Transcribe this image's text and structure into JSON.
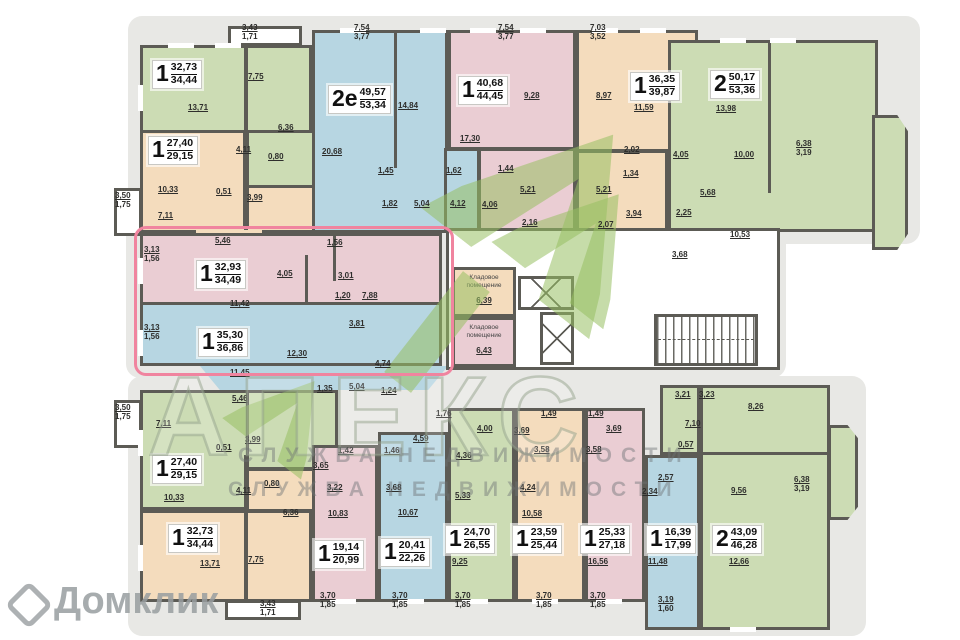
{
  "colors": {
    "wall": "#5c5b55",
    "green_unit": "#ccdcb4",
    "blue_unit": "#b7d6e2",
    "pink_unit": "#eacdd3",
    "orange_unit": "#f4dcbd",
    "highlight": "#f0849f",
    "watermark_green": "#98c062"
  },
  "units": [
    {
      "num": "1",
      "a1": "32,73",
      "a2": "34,44",
      "dims": [
        "13,71",
        "7,75",
        "6,36",
        "4,11",
        "0,80"
      ],
      "bay": [
        "3,43",
        "1,71"
      ]
    },
    {
      "num": "1",
      "a1": "27,40",
      "a2": "29,15",
      "dims": [
        "10,33",
        "0,51",
        "3,99",
        "7,11",
        "5,46"
      ],
      "bay": [
        "3,50",
        "1,75"
      ]
    },
    {
      "num": "2е",
      "a1": "49,57",
      "a2": "53,34",
      "dims": [
        "20,68",
        "14,84",
        "1,45",
        "1,82",
        "5,04",
        "1,62",
        "4,12"
      ],
      "bay": [
        "7,54",
        "3,77"
      ]
    },
    {
      "num": "1",
      "a1": "40,68",
      "a2": "44,45",
      "dims": [
        "17,30",
        "9,28",
        "1,44",
        "5,21",
        "4,06",
        "2,16"
      ],
      "bay": [
        "7,54",
        "3,77"
      ]
    },
    {
      "num": "1",
      "a1": "36,35",
      "a2": "39,87",
      "dims": [
        "11,59",
        "8,97",
        "2,02",
        "1,34",
        "5,21",
        "3,94",
        "2,07"
      ],
      "bay": [
        "7,03",
        "3,52"
      ]
    },
    {
      "num": "2",
      "a1": "50,17",
      "a2": "53,36",
      "dims": [
        "13,98",
        "10,00",
        "5,68",
        "4,05",
        "2,25",
        "3,68",
        "10,53"
      ],
      "bay": [
        "6,38",
        "3,19"
      ]
    },
    {
      "num": "1",
      "a1": "32,93",
      "a2": "34,49",
      "dims": [
        "11,42",
        "4,05",
        "3,01",
        "1,20",
        "7,88",
        "3,81",
        "1,56"
      ],
      "bay": [
        "3,13",
        "1,56"
      ]
    },
    {
      "num": "1",
      "a1": "35,30",
      "a2": "36,86",
      "dims": [
        "12,30",
        "11,45",
        "1,35",
        "5,04",
        "1,24",
        "4,74"
      ],
      "bay": [
        "3,13",
        "1,56"
      ]
    },
    {
      "num": "1",
      "a1": "27,40",
      "a2": "29,15",
      "dims": [
        "7,11",
        "5,46",
        "0,51",
        "3,99",
        "10,33"
      ],
      "bay": [
        "3,50",
        "1,75"
      ]
    },
    {
      "num": "1",
      "a1": "32,73",
      "a2": "34,44",
      "dims": [
        "4,11",
        "0,80",
        "6,36",
        "13,71",
        "7,75"
      ],
      "bay": [
        "3,43",
        "1,71"
      ]
    },
    {
      "num": "1",
      "a1": "19,14",
      "a2": "20,99",
      "dims": [
        "1,42",
        "3,65",
        "3,22",
        "10,83"
      ],
      "bay": [
        "3,70",
        "1,85"
      ]
    },
    {
      "num": "1",
      "a1": "20,41",
      "a2": "22,26",
      "dims": [
        "4,59",
        "1,46",
        "3,68",
        "10,67"
      ],
      "bay": [
        "3,70",
        "1,85"
      ]
    },
    {
      "num": "1",
      "a1": "24,70",
      "a2": "26,55",
      "dims": [
        "1,76",
        "4,00",
        "4,36",
        "5,33",
        "9,25"
      ],
      "bay": [
        "3,70",
        "1,85"
      ]
    },
    {
      "num": "1",
      "a1": "23,59",
      "a2": "25,44",
      "dims": [
        "1,49",
        "3,69",
        "3,58",
        "4,24",
        "10,58"
      ],
      "bay": [
        "3,70",
        "1,85"
      ]
    },
    {
      "num": "1",
      "a1": "25,33",
      "a2": "27,18",
      "dims": [
        "1,49",
        "3,69",
        "3,58",
        "16,56"
      ],
      "bay": [
        "3,70",
        "1,85"
      ]
    },
    {
      "num": "1",
      "a1": "16,39",
      "a2": "17,99",
      "dims": [
        "2,57",
        "2,34",
        "11,48"
      ],
      "bay": [
        "3,19",
        "1,60"
      ]
    },
    {
      "num": "2",
      "a1": "43,09",
      "a2": "46,28",
      "dims": [
        "3,21",
        "3,23",
        "7,10",
        "0,57",
        "8,26",
        "9,56",
        "12,66"
      ],
      "bay": [
        "6,38",
        "3,19"
      ]
    }
  ],
  "storage": [
    {
      "label": "Кладовое помещение",
      "area": "6,39"
    },
    {
      "label": "Кладовое помещение",
      "area": "6,43"
    }
  ],
  "watermarks": {
    "brand": "АПЕКС",
    "line1": "СЛУЖБА НЕДВИЖИМОСТИ",
    "line2": "СЛУЖБА НЕДВИЖИМОСТИ",
    "portal": "Домклик"
  }
}
